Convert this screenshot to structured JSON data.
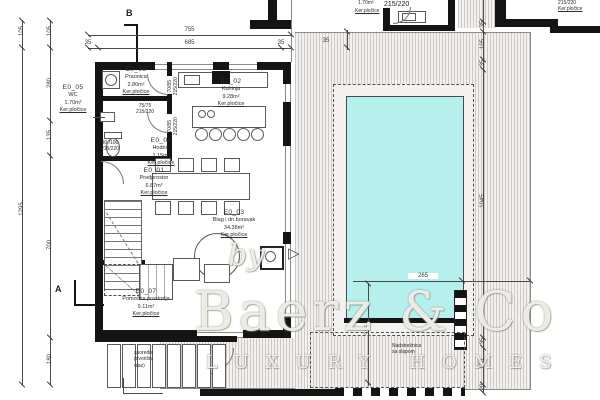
{
  "plan": {
    "markers": {
      "a": "A",
      "b": "B"
    },
    "rooms": [
      {
        "id": "E0_05",
        "name": "WC",
        "area": "1.70m²",
        "floor": "Ker.pločice"
      },
      {
        "id": "E0_06",
        "name": "Praonica",
        "area": "2.80m²",
        "floor": "Ker.pločice"
      },
      {
        "id": "E0_02",
        "name": "Kuhinja",
        "area": "9.28m²",
        "floor": "Ker.pločice"
      },
      {
        "id": "E0_04",
        "name": "Hodnik",
        "area": "1.15m²",
        "floor": "Ker.pločice"
      },
      {
        "id": "E0_01",
        "name": "Predprostor",
        "area": "6.87m²",
        "floor": "Ker.pločice"
      },
      {
        "id": "E0_03",
        "name": "Blag i dn.boravak",
        "area": "34.38m²",
        "floor": "Ker.pločice"
      },
      {
        "id": "E0_07",
        "name": "Pomoćna prostorija",
        "area": "9.11m²",
        "floor": "Ker.pločice"
      }
    ],
    "outdoor_room": {
      "area": "1.70m²",
      "door": "215/220",
      "floor": "Ker.pločice"
    },
    "corner_room": {
      "door": "215/220",
      "floor": "Ker.pločice"
    },
    "doors": [
      {
        "size": "70/85",
        "frame": "215/220"
      },
      {
        "size": "70/85",
        "frame": "215/220"
      },
      {
        "size": "75/75",
        "frame": "215/220"
      },
      {
        "size": "90 /100",
        "frame": "215/220"
      }
    ],
    "dims": {
      "top_overall": "755",
      "top_l": "35",
      "top_m": "685",
      "top_r": "35",
      "left_outer_1": "105",
      "left_outer_2": "1295",
      "left_1": "105",
      "left_2": "280",
      "left_3": "135",
      "left_4": "700",
      "left_5": "180",
      "right_1": "35",
      "right_2": "105",
      "right_3": "35",
      "right_4": "1045",
      "right_5": "35",
      "right_6": "150",
      "right_7": "20",
      "deck_gap": "35",
      "pool_w": "265",
      "pool_d": "315"
    },
    "notes": {
      "canopy_1": "Nadstrešnica",
      "canopy_2": "sa slapom",
      "entrance_1": "sporedni",
      "entrance_2": "(dvorišni",
      "entrance_3": "ulaz)"
    }
  },
  "watermark": {
    "by": "by",
    "brand": "Baerz & Co",
    "tagline": "LUXURY HOMES"
  },
  "colors": {
    "pool": "#b6f0ed",
    "wall": "#141414",
    "hatch_line": "#cdcac5",
    "dim_text": "#3a3a3a"
  }
}
